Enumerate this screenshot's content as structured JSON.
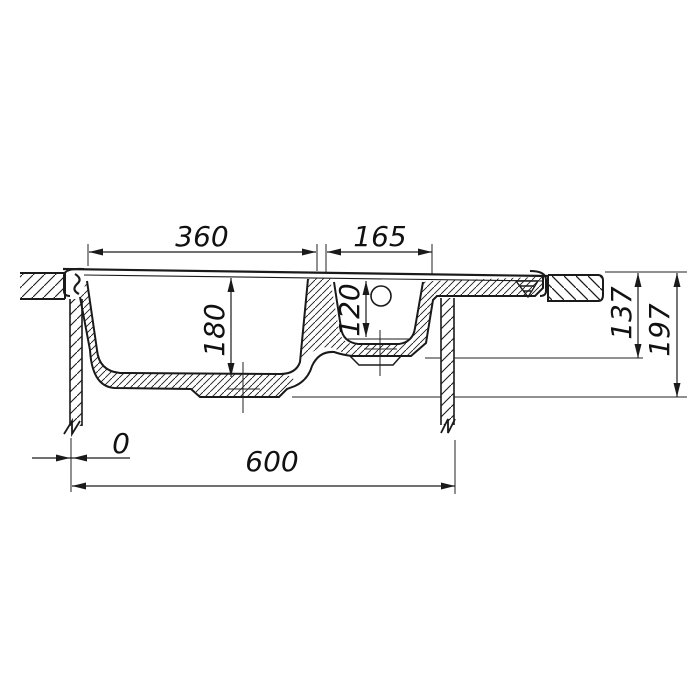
{
  "drawing": {
    "subject": "double-bowl sink cross-section technical drawing",
    "colors": {
      "line": "#1a1a1a",
      "background": "#ffffff"
    },
    "dims": {
      "main_bowl_width": "360",
      "small_bowl_width": "165",
      "main_bowl_depth": "180",
      "small_bowl_depth": "120",
      "height_to_small_bowl_bottom": "137",
      "height_to_main_bowl_bottom": "197",
      "edge_offset": "0",
      "overall_width": "600"
    }
  }
}
